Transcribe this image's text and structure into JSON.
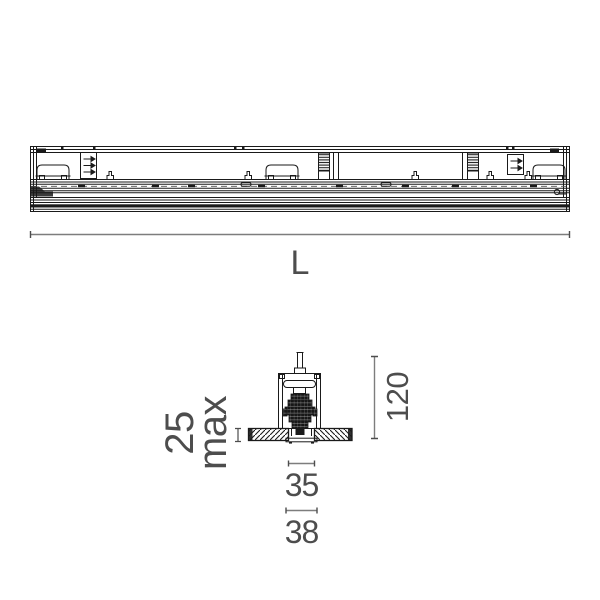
{
  "drawing": {
    "kind": "recessed linear luminaire technical drawing",
    "views": {
      "side_elevation": "full-length side view",
      "cross_section": "recessed mounting section"
    }
  },
  "dimensions": {
    "length": "L",
    "height": "120",
    "recess": {
      "value": "25",
      "suffix": "max"
    },
    "cutout_width": "35",
    "overall_width": "38"
  },
  "colors": {
    "line": "#1a1a1a",
    "dim_line": "#7d7d7d",
    "dim_text": "#4d4d4d",
    "background": "#ffffff"
  }
}
